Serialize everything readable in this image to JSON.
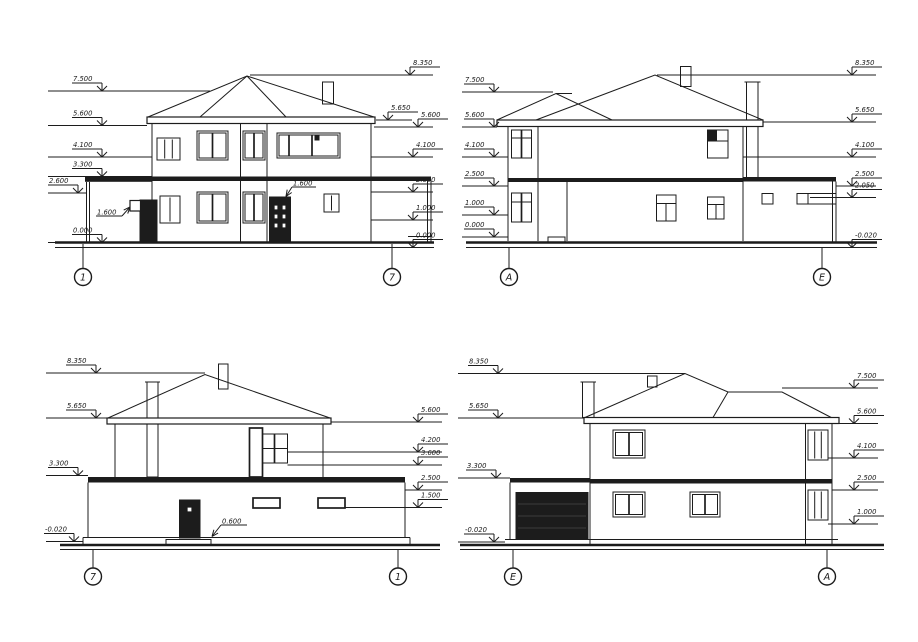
{
  "drawing": {
    "background": "#ffffff",
    "line_color": "#1c1c1c",
    "views": [
      {
        "id": "elevation-1-7",
        "axes": [
          {
            "label": "1",
            "x": 83,
            "cy": 277,
            "y1": 244,
            "y2": 268.5
          },
          {
            "label": "7",
            "x": 392,
            "cy": 277,
            "y1": 244,
            "y2": 268.5
          }
        ],
        "marks": [
          {
            "label": "7.500",
            "side": "L",
            "y": 91,
            "x1": 48,
            "x2": 210,
            "ax": 102
          },
          {
            "label": "5.600",
            "side": "L",
            "y": 125.5,
            "x1": 48,
            "x2": 147,
            "ax": 102
          },
          {
            "label": "4.100",
            "side": "L",
            "y": 157,
            "x1": 48,
            "x2": 152,
            "ax": 102
          },
          {
            "label": "3.300",
            "side": "L",
            "y": 176.5,
            "x1": 48,
            "x2": 152,
            "ax": 102
          },
          {
            "label": "2.600",
            "side": "L",
            "y": 193,
            "x1": 48,
            "x2": 87,
            "ax": 78
          },
          {
            "label": "0.000",
            "side": "L",
            "y": 242.5,
            "x1": 48,
            "x2": 150,
            "ax": 102
          },
          {
            "label": "8.350",
            "side": "R",
            "y": 75,
            "x1": 250,
            "x2": 433,
            "ax": 410
          },
          {
            "label": "5.650",
            "side": "R",
            "y": 120,
            "x1": 376,
            "x2": 412,
            "ax": 388
          },
          {
            "label": "5.600",
            "side": "R",
            "y": 127,
            "x1": 374,
            "x2": 433,
            "ax": 418
          },
          {
            "label": "4.100",
            "side": "R",
            "y": 157,
            "x1": 371,
            "x2": 433,
            "ax": 413
          },
          {
            "label": "2.600",
            "side": "R",
            "y": 192,
            "x1": 371,
            "x2": 433,
            "ax": 413
          },
          {
            "label": "1.000",
            "side": "R",
            "y": 220,
            "x1": 371,
            "x2": 433,
            "ax": 413
          },
          {
            "label": "0.000",
            "side": "R",
            "y": 247.5,
            "x1": 374,
            "x2": 433,
            "ax": 413
          }
        ],
        "annotations": [
          {
            "text": "1.600",
            "tx": 97,
            "ty": 214.5,
            "shelf": [
              96,
              216,
              122,
              216
            ],
            "tip": [
              130,
              207
            ]
          },
          {
            "text": "1.600",
            "tx": 293,
            "ty": 185.5,
            "shelf": [
              292,
              187,
              316,
              187
            ],
            "tip": [
              286,
              196.5
            ]
          }
        ]
      },
      {
        "id": "elevation-A-E",
        "axes": [
          {
            "label": "А",
            "x": 509,
            "cy": 277,
            "y1": 248,
            "y2": 268.5
          },
          {
            "label": "Е",
            "x": 822,
            "cy": 277,
            "y1": 248,
            "y2": 268.5
          }
        ],
        "marks": [
          {
            "label": "7.500",
            "side": "L",
            "y": 92,
            "x1": 462,
            "x2": 553,
            "ax": 494
          },
          {
            "label": "5.600",
            "side": "L",
            "y": 127,
            "x1": 462,
            "x2": 497,
            "ax": 494
          },
          {
            "label": "4.100",
            "side": "L",
            "y": 157,
            "x1": 462,
            "x2": 508,
            "ax": 494
          },
          {
            "label": "2.500",
            "side": "L",
            "y": 186,
            "x1": 462,
            "x2": 508,
            "ax": 494
          },
          {
            "label": "1.000",
            "side": "L",
            "y": 215,
            "x1": 462,
            "x2": 508,
            "ax": 494
          },
          {
            "label": "0.000",
            "side": "L",
            "y": 237,
            "x1": 462,
            "x2": 508,
            "ax": 494
          },
          {
            "label": "8.350",
            "side": "R",
            "y": 75,
            "x1": 657,
            "x2": 876,
            "ax": 852
          },
          {
            "label": "5.650",
            "side": "R",
            "y": 122,
            "x1": 763,
            "x2": 876,
            "ax": 852
          },
          {
            "label": "4.100",
            "side": "R",
            "y": 157,
            "x1": 743,
            "x2": 876,
            "ax": 852
          },
          {
            "label": "2.500",
            "side": "R",
            "y": 186,
            "x1": 836,
            "x2": 876,
            "ax": 852
          },
          {
            "label": "2.050",
            "side": "R",
            "y": 197.5,
            "x1": 810,
            "x2": 876,
            "ax": 852
          },
          {
            "label": "-0.020",
            "side": "R",
            "y": 247.5,
            "x1": 836,
            "x2": 876,
            "ax": 852
          }
        ],
        "annotations": []
      },
      {
        "id": "elevation-7-1",
        "axes": [
          {
            "label": "7",
            "x": 93,
            "cy": 576.5,
            "y1": 549.5,
            "y2": 568
          },
          {
            "label": "1",
            "x": 398,
            "cy": 576.5,
            "y1": 549.5,
            "y2": 568
          }
        ],
        "marks": [
          {
            "label": "8.350",
            "side": "L",
            "y": 373,
            "x1": 46,
            "x2": 205,
            "ax": 96
          },
          {
            "label": "5.650",
            "side": "L",
            "y": 418,
            "x1": 46,
            "x2": 107,
            "ax": 96
          },
          {
            "label": "3.300",
            "side": "L",
            "y": 475.5,
            "x1": 46,
            "x2": 88,
            "ax": 78
          },
          {
            "label": "-0.020",
            "side": "L",
            "y": 541.5,
            "x1": 46,
            "x2": 83,
            "ax": 74
          },
          {
            "label": "5.600",
            "side": "R",
            "y": 422,
            "x1": 331,
            "x2": 442,
            "ax": 418
          },
          {
            "label": "4.200",
            "side": "R",
            "y": 452,
            "x1": 287.5,
            "x2": 442,
            "ax": 418
          },
          {
            "label": "3.600",
            "side": "R",
            "y": 465,
            "x1": 287.5,
            "x2": 442,
            "ax": 418
          },
          {
            "label": "2.500",
            "side": "R",
            "y": 490,
            "x1": 405,
            "x2": 442,
            "ax": 418
          },
          {
            "label": "1.500",
            "side": "R",
            "y": 507.5,
            "x1": 345,
            "x2": 442,
            "ax": 418
          }
        ],
        "annotations": [
          {
            "text": "0.600",
            "tx": 222,
            "ty": 523.5,
            "shelf": [
              221,
              525,
              247,
              525
            ],
            "tip": [
              212,
              536.5
            ]
          }
        ]
      },
      {
        "id": "elevation-E-A",
        "axes": [
          {
            "label": "Е",
            "x": 513,
            "cy": 576.5,
            "y1": 549.5,
            "y2": 568
          },
          {
            "label": "А",
            "x": 827,
            "cy": 576.5,
            "y1": 549.5,
            "y2": 568
          }
        ],
        "marks": [
          {
            "label": "8.350",
            "side": "L",
            "y": 373.5,
            "x1": 458,
            "x2": 685,
            "ax": 498
          },
          {
            "label": "5.650",
            "side": "L",
            "y": 418,
            "x1": 458,
            "x2": 584,
            "ax": 498
          },
          {
            "label": "3.300",
            "side": "L",
            "y": 478,
            "x1": 458,
            "x2": 510,
            "ax": 496
          },
          {
            "label": "-0.020",
            "side": "L",
            "y": 542,
            "x1": 458,
            "x2": 505,
            "ax": 494
          },
          {
            "label": "7.500",
            "side": "R",
            "y": 388,
            "x1": 782,
            "x2": 878,
            "ax": 854
          },
          {
            "label": "5.600",
            "side": "R",
            "y": 423.5,
            "x1": 839,
            "x2": 878,
            "ax": 854
          },
          {
            "label": "4.100",
            "side": "R",
            "y": 458,
            "x1": 828,
            "x2": 878,
            "ax": 854
          },
          {
            "label": "2.500",
            "side": "R",
            "y": 490,
            "x1": 832,
            "x2": 878,
            "ax": 854
          },
          {
            "label": "1.000",
            "side": "R",
            "y": 524,
            "x1": 828,
            "x2": 878,
            "ax": 854
          }
        ],
        "annotations": []
      }
    ]
  }
}
